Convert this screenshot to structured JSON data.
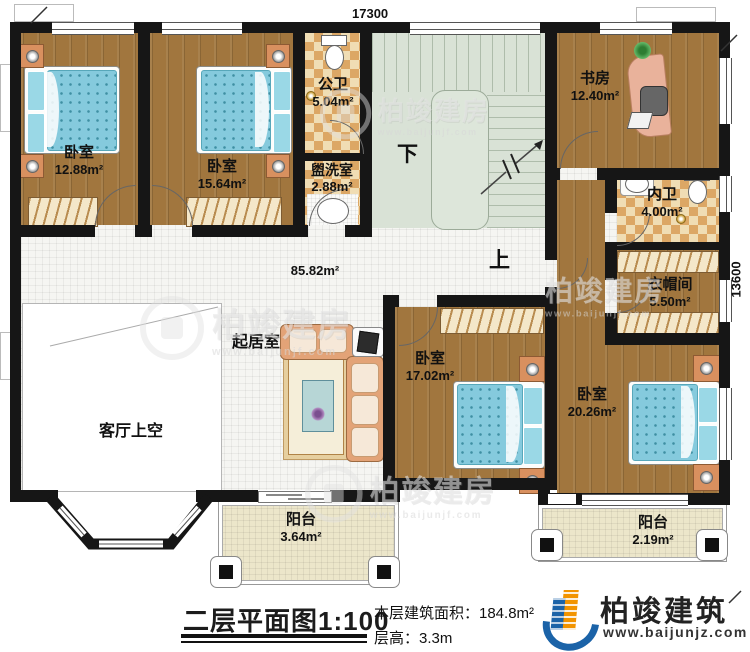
{
  "title_block": {
    "title": "二层平面图1:100",
    "floor_area": "本层建筑面积：184.8m²",
    "floor_height": "层高：3.3m"
  },
  "brand": {
    "name": "柏竣建筑",
    "url": "www.baijunjz.com"
  },
  "watermark": {
    "text": "柏竣建房",
    "url": "www.baijunjf.com"
  },
  "dimensions": {
    "width": "17300",
    "height": "13600"
  },
  "stairs": {
    "down": "下",
    "up": "上"
  },
  "rooms": [
    {
      "id": "bedroom-1",
      "name": "卧室",
      "area": "12.88m²"
    },
    {
      "id": "bedroom-2",
      "name": "卧室",
      "area": "15.64m²"
    },
    {
      "id": "public-bath",
      "name": "公卫",
      "area": "5.04m²"
    },
    {
      "id": "washroom",
      "name": "盥洗室",
      "area": "2.88m²"
    },
    {
      "id": "study",
      "name": "书房",
      "area": "12.40m²"
    },
    {
      "id": "private-bath",
      "name": "内卫",
      "area": "4.00m²"
    },
    {
      "id": "cloakroom",
      "name": "衣帽间",
      "area": "5.50m²"
    },
    {
      "id": "hall",
      "name": "",
      "area": "85.82m²"
    },
    {
      "id": "living-room",
      "name": "起居室",
      "area": ""
    },
    {
      "id": "bedroom-3",
      "name": "卧室",
      "area": "17.02m²"
    },
    {
      "id": "bedroom-4",
      "name": "卧室",
      "area": "20.26m²"
    },
    {
      "id": "void",
      "name": "客厅上空",
      "area": ""
    },
    {
      "id": "balcony-1",
      "name": "阳台",
      "area": "3.64m²"
    },
    {
      "id": "balcony-2",
      "name": "阳台",
      "area": "2.19m²"
    }
  ],
  "colors": {
    "wall": "#161616",
    "wood": "#a1763e",
    "tile": "#f5f5f2",
    "stairs": "#d9e2d6",
    "bath_checker": "#dca765",
    "balcony": "#ece6ca",
    "bed": "#85cadd",
    "sofa": "#e3a377",
    "logo_blue": "#1b63a8",
    "logo_orange": "#f29400"
  }
}
